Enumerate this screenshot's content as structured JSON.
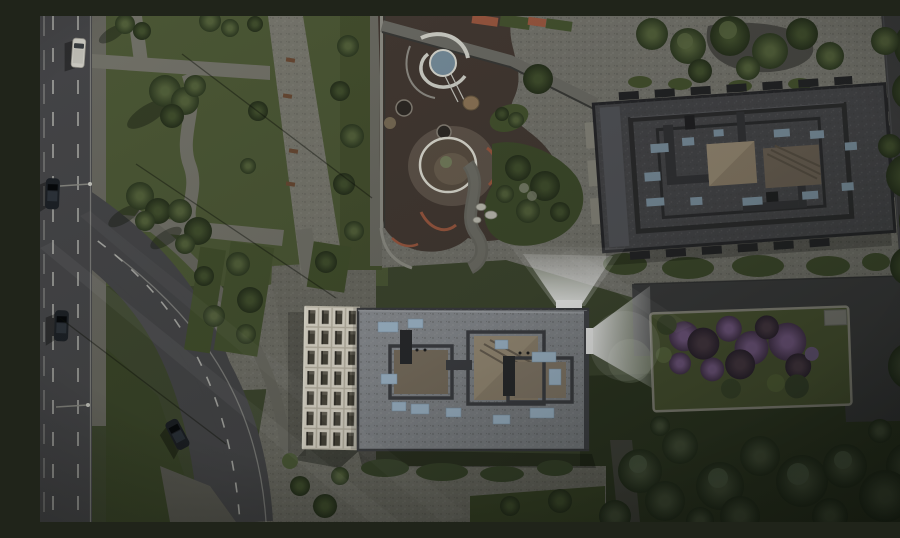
{
  "meta": {
    "title": "Aerial dusk 3D render of a residential complex",
    "view": "top-down aerial",
    "time_of_day": "dusk"
  },
  "scene": {
    "elements": [
      "left-highway-with-dashed-lanes",
      "curved-street",
      "linear-park-with-paths-and-promenade",
      "playground-with-spiral-fountain-and-sand-pits",
      "gravel-plaza",
      "north-building-dark-roof",
      "south-building-white-grid-facade",
      "rooftop-light-beams",
      "lilac-garden-bed",
      "east-service-road",
      "woodland-trees"
    ],
    "vehicles": {
      "white_van_on_highway": 1,
      "dark_cars_on_highway": 2,
      "dark_car_on_curved_street": 1
    }
  },
  "colors": {
    "base_lawn": "#3f4830",
    "park_grass": "#4e5a37",
    "dark_lawn": "#2e3722",
    "gravel_light": "#787770",
    "gravel_mid": "#6f6e66",
    "path_gray": "#76756c",
    "promenade": "#7b7a71",
    "road_asphalt": "#47474a",
    "road_line": "#cfcfc9",
    "drive_asphalt": "#3c3c3e",
    "playground_rubber": "#453a34",
    "sand_tan": "#7d6f58",
    "sand_dark": "#5c5044",
    "fountain_water": "#7b93a3",
    "fountain_ring": "#d9d9d1",
    "terracotta": "#a05a42",
    "roof_dark": "#46464a",
    "parapet_dark": "#2b2b2d",
    "roof_light": "#8c8f94",
    "roof_tan": "#968874",
    "skylight_dark": "#7e93a3",
    "skylight_light": "#aac3d9",
    "facade_frame": "#eee8da",
    "facade_window": "#4a463c",
    "hedge_green": "#3f4b2d",
    "tree_green": "#55633c",
    "tree_dark": "#37432a",
    "purple_bloom": "#6d5279",
    "glow_white": "#ffffff",
    "car_dark": "#1d2127",
    "car_white": "#d6d4cc",
    "bench_brown": "#6b4a34"
  }
}
